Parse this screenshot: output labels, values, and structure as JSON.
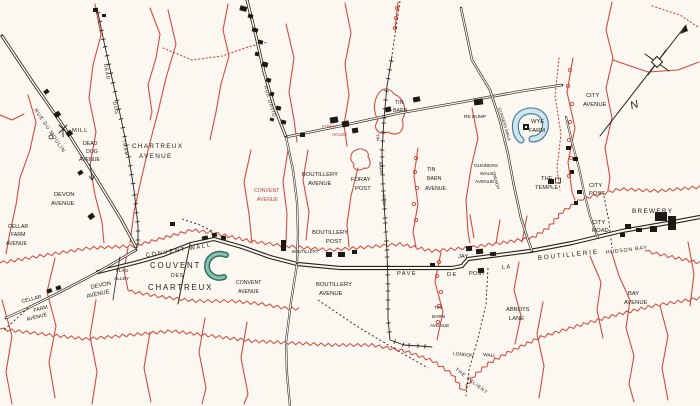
{
  "map_title": "Trench map — Couvent des Chartreux sector",
  "colors": {
    "paper": "#faf8f1",
    "ink": "#26211c",
    "trench_red": "#d5453a",
    "water_blue": "#b9d9e6",
    "water_edge": "#4a7f99",
    "moat_teal": "#2f7364"
  },
  "labels": {
    "rue_du_moulin": "RUE DU MOULIN",
    "mill": "MILL",
    "dead_dog_avenue": [
      "DEAD",
      "DOG",
      "AVENUE"
    ],
    "dead_dog_tram": [
      "DEAD",
      "DOG",
      "TRAM"
    ],
    "chartreux_avenue": [
      "CHARTREUX",
      "AVENUE"
    ],
    "devon_avenue_nw": [
      "DEVON",
      "AVENUE"
    ],
    "cellar_farm_avenue_n": [
      "CELLAR",
      "FARM",
      "AVENUE"
    ],
    "convent_wall": "CONVENT WALL",
    "couvent_des_chartreux": [
      "COUVENT",
      "DES",
      "CHARTREUX"
    ],
    "flag_alley": [
      "FLAG",
      "ALLEY"
    ],
    "devon_avenue_s": [
      "DEVON",
      "AVENUE"
    ],
    "cellar_farm_avenue_s": [
      "CELLAR",
      "FARM",
      "AVENUE"
    ],
    "convent_avenue_n": [
      "CONVENT",
      "AVENUE"
    ],
    "convent_avenue_s": [
      "CONVENT",
      "AVENUE"
    ],
    "boutillery_avenue_n": [
      "BOUTILLERY",
      "AVENUE"
    ],
    "boutillery_avenue_s": [
      "BOUTILLERY",
      "AVENUE"
    ],
    "boutillery_post": [
      "BOUTILLERY",
      "POST"
    ],
    "boutillery_farm": "BOUTILLERY",
    "foray_post": [
      "FORAY",
      "POST"
    ],
    "foray_house": [
      "FORAY",
      "HOUSE"
    ],
    "rue_david": "RUE DAVID",
    "tin_barn": [
      "TIN",
      "BARN"
    ],
    "tin_barn_tram": [
      "TIN",
      "BARN",
      "TRAM"
    ],
    "re_dump": "RE DUMP",
    "wye_farm": [
      "WYE",
      "FARM"
    ],
    "gunners_walk_avenue": [
      "GUNNERS",
      "WALK",
      "AVENUE"
    ],
    "gunners_walk_trench": [
      "GUNNERS WALK",
      "TRENCH"
    ],
    "tin_barn_avenue_n": [
      "TIN",
      "BARN",
      "AVENUE"
    ],
    "tin_barn_avenue_s": [
      "TIN",
      "BARN",
      "AVENUE"
    ],
    "the_temple": [
      "THE",
      "TEMPLE"
    ],
    "city_avenue": [
      "CITY",
      "AVENUE"
    ],
    "city_post": [
      "CITY",
      "POST"
    ],
    "city_road": [
      "CITY",
      "ROAD"
    ],
    "brewery": "BREWERY",
    "hudson_bay": "HUDSON BAY",
    "bay_avenue": [
      "BAY",
      "AVENUE"
    ],
    "pave_de_la_boutillerie": [
      "PAVE",
      "DE",
      "LA",
      "BOUTILLERIE"
    ],
    "jay_post": [
      "JAY",
      "POST"
    ],
    "abbots_lane": [
      "ABBOTS",
      "LANE"
    ],
    "london_wall": [
      "LONDON",
      "WALL"
    ],
    "the_salient": "THE SALIENT",
    "compass_north": "N"
  }
}
